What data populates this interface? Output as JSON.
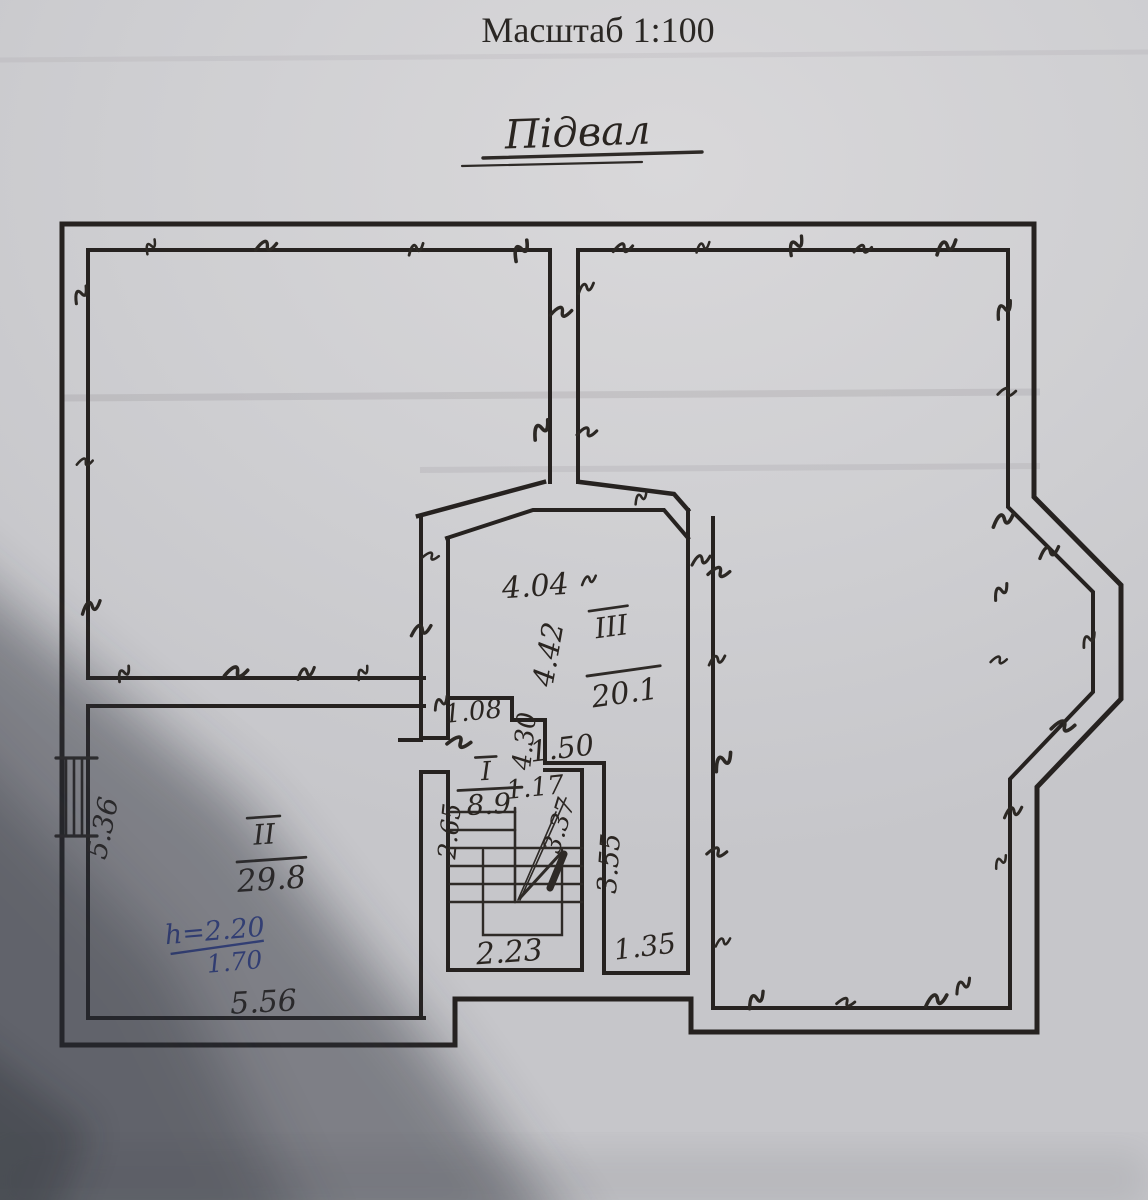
{
  "header": {
    "scale_label": "Масштаб 1:100",
    "plan_title": "Підвал"
  },
  "rooms": [
    {
      "numeral": "I",
      "area": "8.9"
    },
    {
      "numeral": "II",
      "area": "29.8"
    },
    {
      "numeral": "III",
      "area": "20.1"
    }
  ],
  "dims": {
    "room3_width": "4.04",
    "room3_height": "4.42",
    "vestibule_width": "1.08",
    "wall_left_lower": "4.30",
    "wall_150": "1.50",
    "wall_117": "1.17",
    "stair_flight": "2.65",
    "stair_diagonal": "3.37",
    "wall_355": "3.55",
    "stair_width": "2.23",
    "nook_width": "1.35",
    "room2_left": "5.36",
    "room2_bottom": "5.56"
  },
  "notes": {
    "blue_line1": "h=2.20",
    "blue_line2": "1.70"
  },
  "colors": {
    "ink": "#27231f",
    "blue_ink": "#3a4da6",
    "paper": "#d2d1d3",
    "shadow": "#2b2e38"
  }
}
